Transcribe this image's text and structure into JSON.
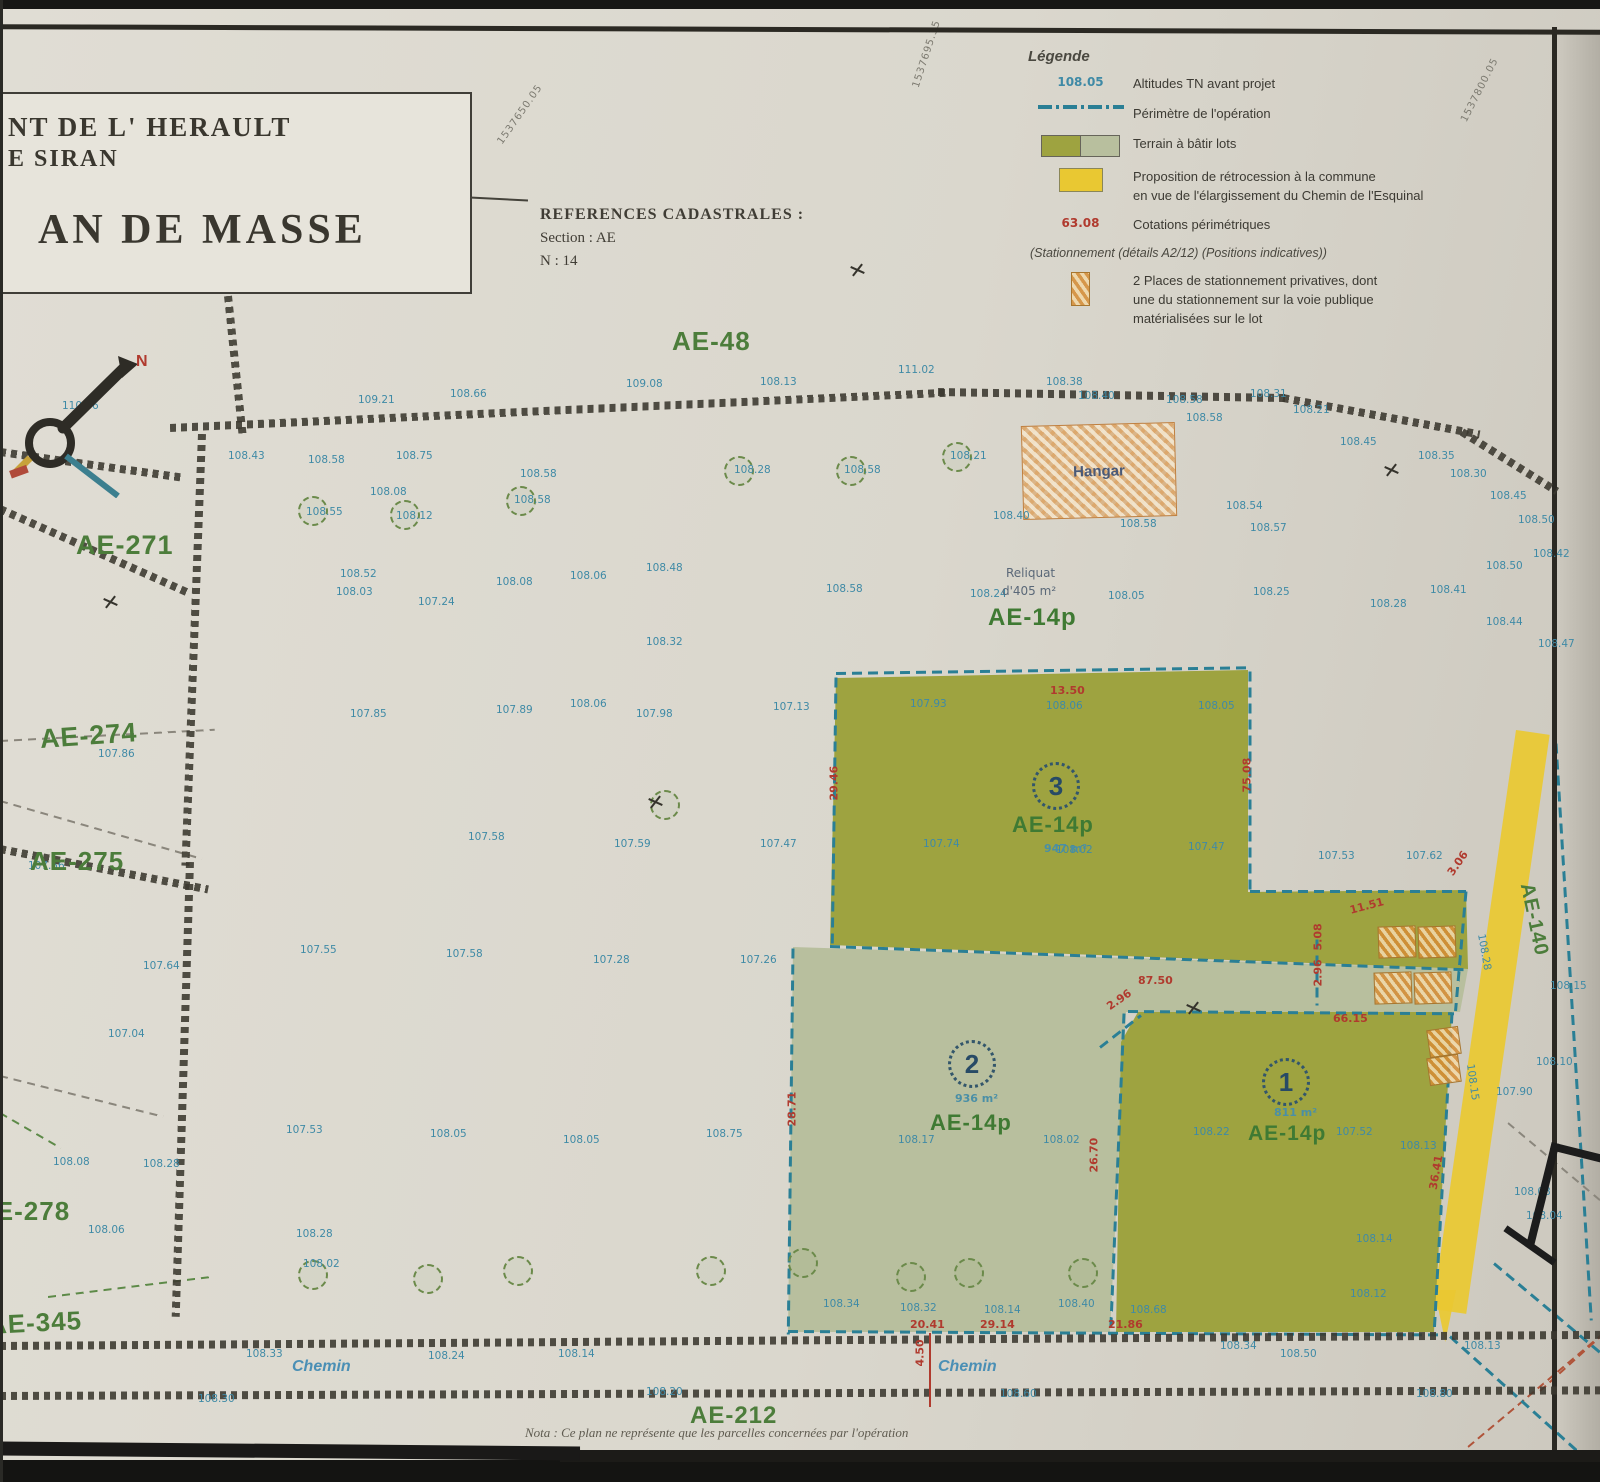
{
  "title_block": {
    "line1": "NT DE L' HERAULT",
    "line2": "E SIRAN",
    "line3": "AN DE MASSE"
  },
  "cadastral": {
    "heading": "REFERENCES CADASTRALES :",
    "section": "Section : AE",
    "numero": "N : 14"
  },
  "north_label": "N",
  "legend": {
    "title": "Légende",
    "items": [
      {
        "sample": "108.05",
        "label": "Altitudes TN avant projet"
      },
      {
        "label": "Périmètre de l'opération"
      },
      {
        "label": "Terrain à bâtir lots"
      },
      {
        "label_line1": "Proposition de rétrocession à la commune",
        "label_line2": "en vue de l'élargissement du Chemin de l'Esquinal"
      },
      {
        "sample": "63.08",
        "label": "Cotations périmétriques"
      },
      {
        "note": "(Stationnement (détails A2/12) (Positions indicatives))"
      },
      {
        "label_line1": "2 Places de stationnement privatives, dont",
        "label_line2": "une du stationnement sur la voie publique",
        "label_line3": "matérialisées sur le lot"
      }
    ]
  },
  "lots": {
    "lot1": {
      "number": "1",
      "area": "811 m²",
      "parcel": "AE-14p"
    },
    "lot2": {
      "number": "2",
      "area": "936 m²",
      "parcel": "AE-14p"
    },
    "lot3": {
      "number": "3",
      "area": "947 m²",
      "parcel": "AE-14p"
    }
  },
  "reliquat": {
    "line1": "Reliquat",
    "line2": "d'405 m²",
    "parcel": "AE-14p"
  },
  "hangar": {
    "label": "Hangar"
  },
  "roads": {
    "left": "Chemin",
    "right": "Chemin"
  },
  "note": "Nota : Ce plan ne représente que les parcelles concernées par l'opération",
  "colors": {
    "paper": "#dad7cd",
    "lot_dark": "#9ea340",
    "lot_light": "#b8bf9e",
    "retrocession_yellow": "#e9c832",
    "perimeter_teal": "#2a7f95",
    "cotation_red": "#b03a2e",
    "elevation_blue": "#3f8aa6",
    "parcel_green": "#4c7d3b",
    "parking_orange": "#d08a3c"
  },
  "map": {
    "parcel_labels": [
      [
        672,
        326,
        "AE-48",
        0,
        26
      ],
      [
        76,
        530,
        "AE-271",
        0,
        27
      ],
      [
        40,
        724,
        "AE-274",
        -4,
        27
      ],
      [
        30,
        846,
        "AE-275",
        0,
        26
      ],
      [
        -24,
        1196,
        "AE-278",
        0,
        26
      ],
      [
        -12,
        1310,
        "AE-345",
        -3,
        26
      ],
      [
        690,
        1402,
        "AE-212",
        0,
        24
      ],
      [
        1526,
        872,
        "AE-140",
        78,
        20
      ]
    ],
    "coord_labels": [
      [
        500,
        138,
        "1537650.05",
        -55
      ],
      [
        916,
        82,
        "1537695.35",
        -72
      ],
      [
        1464,
        116,
        "1537800.05",
        -63
      ]
    ],
    "spot_heights": [
      [
        62,
        400,
        "110.46"
      ],
      [
        358,
        394,
        "109.21"
      ],
      [
        450,
        388,
        "108.66"
      ],
      [
        626,
        378,
        "109.08"
      ],
      [
        760,
        376,
        "108.13"
      ],
      [
        898,
        364,
        "111.02"
      ],
      [
        1046,
        376,
        "108.38"
      ],
      [
        1166,
        394,
        "108.58"
      ],
      [
        1250,
        388,
        "108.31"
      ],
      [
        1293,
        404,
        "108.21"
      ],
      [
        1340,
        436,
        "108.45"
      ],
      [
        1418,
        450,
        "108.35"
      ],
      [
        1450,
        468,
        "108.30"
      ],
      [
        1490,
        490,
        "108.45"
      ],
      [
        1518,
        514,
        "108.50"
      ],
      [
        1533,
        548,
        "108.42"
      ],
      [
        1486,
        560,
        "108.50"
      ],
      [
        1430,
        584,
        "108.41"
      ],
      [
        1486,
        616,
        "108.44"
      ],
      [
        1538,
        638,
        "108.47"
      ],
      [
        228,
        450,
        "108.43"
      ],
      [
        308,
        454,
        "108.58"
      ],
      [
        396,
        450,
        "108.75"
      ],
      [
        520,
        468,
        "108.58"
      ],
      [
        370,
        486,
        "108.08"
      ],
      [
        306,
        506,
        "108.55"
      ],
      [
        396,
        510,
        "108.12"
      ],
      [
        514,
        494,
        "108.58"
      ],
      [
        734,
        464,
        "108.28"
      ],
      [
        844,
        464,
        "108.58"
      ],
      [
        950,
        450,
        "108.21"
      ],
      [
        993,
        510,
        "108.40"
      ],
      [
        1078,
        390,
        "108.40"
      ],
      [
        1186,
        412,
        "108.58"
      ],
      [
        1226,
        500,
        "108.54"
      ],
      [
        1120,
        518,
        "108.58"
      ],
      [
        1250,
        522,
        "108.57"
      ],
      [
        336,
        586,
        "108.03"
      ],
      [
        340,
        568,
        "108.52"
      ],
      [
        418,
        596,
        "107.24"
      ],
      [
        496,
        576,
        "108.08"
      ],
      [
        570,
        570,
        "108.06"
      ],
      [
        646,
        562,
        "108.48"
      ],
      [
        826,
        583,
        "108.58"
      ],
      [
        970,
        588,
        "108.24"
      ],
      [
        1108,
        590,
        "108.05"
      ],
      [
        1253,
        586,
        "108.25"
      ],
      [
        1370,
        598,
        "108.28"
      ],
      [
        646,
        636,
        "108.32"
      ],
      [
        350,
        708,
        "107.85"
      ],
      [
        496,
        704,
        "107.89"
      ],
      [
        570,
        698,
        "108.06"
      ],
      [
        636,
        708,
        "107.98"
      ],
      [
        773,
        701,
        "107.13"
      ],
      [
        468,
        831,
        "107.58"
      ],
      [
        614,
        838,
        "107.59"
      ],
      [
        760,
        838,
        "107.47"
      ],
      [
        300,
        944,
        "107.55"
      ],
      [
        446,
        948,
        "107.58"
      ],
      [
        593,
        954,
        "107.28"
      ],
      [
        740,
        954,
        "107.26"
      ],
      [
        286,
        1124,
        "107.53"
      ],
      [
        430,
        1128,
        "108.05"
      ],
      [
        563,
        1134,
        "108.05"
      ],
      [
        706,
        1128,
        "108.75"
      ],
      [
        98,
        748,
        "107.86"
      ],
      [
        28,
        860,
        "107.56"
      ],
      [
        143,
        960,
        "107.64"
      ],
      [
        108,
        1028,
        "107.04"
      ],
      [
        53,
        1156,
        "108.08"
      ],
      [
        143,
        1158,
        "108.28"
      ],
      [
        88,
        1224,
        "108.06"
      ],
      [
        296,
        1228,
        "108.28"
      ],
      [
        303,
        1258,
        "108.02"
      ],
      [
        910,
        698,
        "107.93"
      ],
      [
        1046,
        700,
        "108.06"
      ],
      [
        1198,
        700,
        "108.05"
      ],
      [
        923,
        838,
        "107.74"
      ],
      [
        1056,
        844,
        "108.02"
      ],
      [
        1188,
        841,
        "107.47"
      ],
      [
        1318,
        850,
        "107.53"
      ],
      [
        1406,
        850,
        "107.62"
      ],
      [
        898,
        1134,
        "108.17"
      ],
      [
        1043,
        1134,
        "108.02"
      ],
      [
        1193,
        1126,
        "108.22"
      ],
      [
        1336,
        1126,
        "107.52"
      ],
      [
        1400,
        1140,
        "108.13"
      ],
      [
        1356,
        1233,
        "108.14"
      ],
      [
        1350,
        1288,
        "108.12"
      ],
      [
        823,
        1298,
        "108.34"
      ],
      [
        900,
        1302,
        "108.32"
      ],
      [
        984,
        1304,
        "108.14"
      ],
      [
        1058,
        1298,
        "108.40"
      ],
      [
        1130,
        1304,
        "108.68"
      ],
      [
        1220,
        1340,
        "108.34"
      ],
      [
        246,
        1348,
        "108.33"
      ],
      [
        428,
        1350,
        "108.24"
      ],
      [
        558,
        1348,
        "108.14"
      ],
      [
        646,
        1386,
        "108.20"
      ],
      [
        1000,
        1388,
        "108.60"
      ],
      [
        1280,
        1348,
        "108.50"
      ],
      [
        1416,
        1388,
        "108.80"
      ],
      [
        198,
        1393,
        "108.30"
      ],
      [
        1514,
        1186,
        "108.08"
      ],
      [
        1526,
        1210,
        "108.04"
      ],
      [
        1496,
        1086,
        "107.90"
      ],
      [
        1536,
        1056,
        "108.10"
      ],
      [
        1550,
        980,
        "108.15"
      ],
      [
        1464,
        1340,
        "108.13"
      ],
      [
        1481,
        928,
        "108.28",
        80
      ],
      [
        1470,
        1058,
        "108.15",
        82
      ]
    ],
    "cotations": [
      [
        1050,
        684,
        "13.50",
        0
      ],
      [
        834,
        794,
        "29.46",
        -90
      ],
      [
        1247,
        786,
        "75.08",
        -90
      ],
      [
        1350,
        904,
        "11.51",
        -15
      ],
      [
        1318,
        944,
        "5.08",
        -90
      ],
      [
        1318,
        980,
        "2.96",
        -90
      ],
      [
        1138,
        974,
        "87.50",
        0
      ],
      [
        1108,
        1001,
        "2.96",
        -35
      ],
      [
        1333,
        1012,
        "66.15",
        0
      ],
      [
        792,
        1120,
        "28.71",
        -90
      ],
      [
        1094,
        1166,
        "26.70",
        -90
      ],
      [
        910,
        1318,
        "20.41",
        0
      ],
      [
        980,
        1318,
        "29.14",
        0
      ],
      [
        1108,
        1318,
        "21.86",
        0
      ],
      [
        1433,
        1183,
        "36.41",
        -80
      ],
      [
        920,
        1360,
        "4.50",
        -90
      ],
      [
        1450,
        868,
        "3.06",
        -55
      ]
    ],
    "trees": [
      [
        298,
        496
      ],
      [
        390,
        500
      ],
      [
        506,
        486
      ],
      [
        724,
        456
      ],
      [
        836,
        456
      ],
      [
        942,
        442
      ],
      [
        650,
        790
      ],
      [
        298,
        1260
      ],
      [
        413,
        1264
      ],
      [
        503,
        1256
      ],
      [
        696,
        1256
      ],
      [
        788,
        1248
      ],
      [
        896,
        1262
      ],
      [
        954,
        1258
      ],
      [
        1068,
        1258
      ]
    ],
    "benches": [
      [
        103,
        596
      ],
      [
        648,
        796
      ],
      [
        850,
        264
      ],
      [
        1186,
        1002
      ],
      [
        1384,
        464
      ]
    ],
    "chains": [
      [
        170,
        424,
        778,
        -2.6
      ],
      [
        938,
        388,
        352,
        1.0
      ],
      [
        1283,
        394,
        200,
        10.5
      ],
      [
        1462,
        428,
        112,
        32
      ],
      [
        228,
        292,
        142,
        84
      ],
      [
        0,
        448,
        185,
        8
      ],
      [
        0,
        505,
        205,
        24
      ],
      [
        202,
        430,
        432,
        92.2
      ],
      [
        190,
        858,
        455,
        91.8
      ],
      [
        0,
        845,
        212,
        11
      ],
      [
        0,
        1342,
        1602,
        -0.4
      ],
      [
        0,
        1392,
        1602,
        -0.2
      ]
    ],
    "teal_lines": [
      [
        836,
        672,
        416,
        -0.8
      ],
      [
        836,
        676,
        272,
        90.8
      ],
      [
        1250,
        670,
        222,
        90
      ],
      [
        1250,
        890,
        216,
        0
      ],
      [
        830,
        945,
        636,
        2.1
      ],
      [
        1466,
        890,
        120,
        95
      ],
      [
        793,
        947,
        386,
        90.7
      ],
      [
        1128,
        1010,
        326,
        0.4
      ],
      [
        1124,
        1012,
        322,
        92.4
      ],
      [
        1100,
        1046,
        52,
        -38
      ],
      [
        788,
        1330,
        652,
        0.3
      ],
      [
        1452,
        1012,
        321,
        93.2
      ],
      [
        1317,
        938,
        66,
        90
      ],
      [
        1450,
        1335,
        212,
        42
      ],
      [
        1494,
        1262,
        192,
        40
      ],
      [
        1556,
        742,
        578,
        86.5
      ]
    ],
    "gray_lines": [
      [
        0,
        740,
        215,
        -3
      ],
      [
        0,
        800,
        210,
        16
      ],
      [
        0,
        1075,
        168,
        14
      ],
      [
        1508,
        1122,
        152,
        40
      ]
    ],
    "green_lines": [
      [
        48,
        1296,
        165,
        -7
      ],
      [
        0,
        1112,
        70,
        30
      ]
    ],
    "red_lines": [
      [
        1468,
        1446,
        200,
        -40
      ],
      [
        1540,
        1390,
        80,
        -42
      ]
    ],
    "redsolid": [
      [
        930,
        1332,
        74,
        90
      ]
    ],
    "parking": [
      [
        1378,
        926,
        36,
        30,
        -2
      ],
      [
        1418,
        926,
        36,
        30,
        -2
      ],
      [
        1374,
        972,
        36,
        30,
        -2
      ],
      [
        1414,
        972,
        36,
        30,
        -2
      ],
      [
        1428,
        1028,
        30,
        26,
        -8
      ],
      [
        1428,
        1056,
        30,
        26,
        -8
      ]
    ]
  }
}
